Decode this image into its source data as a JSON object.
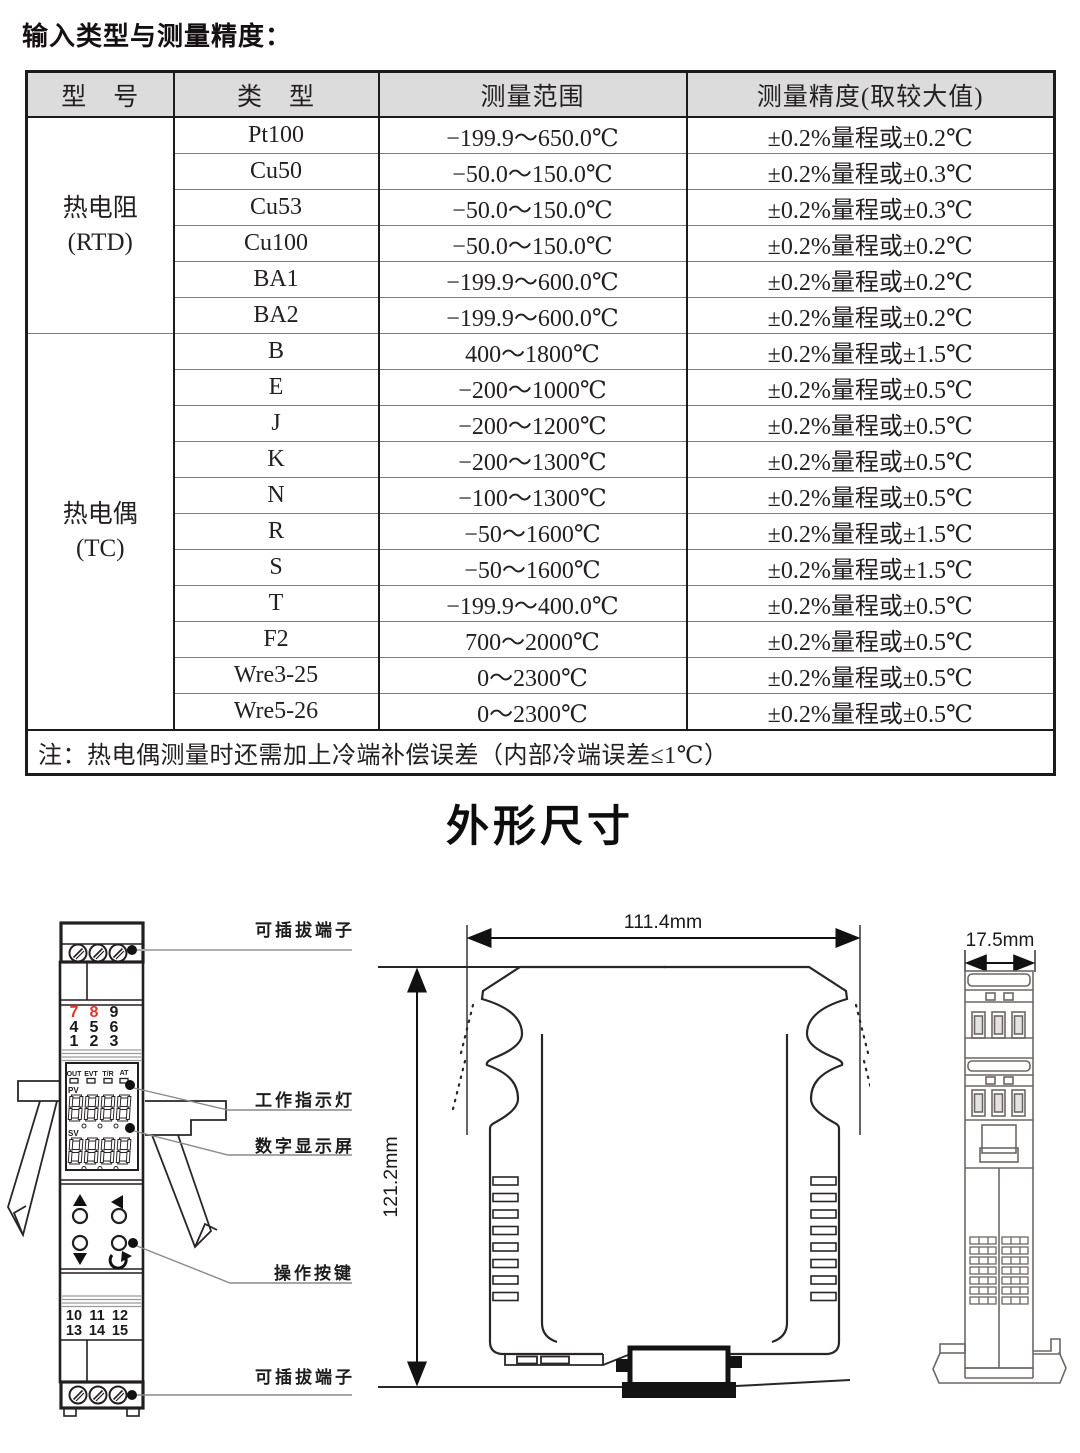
{
  "page": {
    "title": "输入类型与测量精度：",
    "section_title": "外形尺寸"
  },
  "table": {
    "headers": [
      "型　号",
      "类　型",
      "测量范围",
      "测量精度(取较大值)"
    ],
    "group1": {
      "name": "热电阻",
      "abbr": "(RTD)"
    },
    "group2": {
      "name": "热电偶",
      "abbr": "(TC)"
    },
    "rows": [
      {
        "type": "Pt100",
        "range": "−199.9～650.0℃",
        "accuracy": "±0.2%量程或±0.2℃"
      },
      {
        "type": "Cu50",
        "range": "−50.0～150.0℃",
        "accuracy": "±0.2%量程或±0.3℃"
      },
      {
        "type": "Cu53",
        "range": "−50.0～150.0℃",
        "accuracy": "±0.2%量程或±0.3℃"
      },
      {
        "type": "Cu100",
        "range": "−50.0～150.0℃",
        "accuracy": "±0.2%量程或±0.2℃"
      },
      {
        "type": "BA1",
        "range": "−199.9～600.0℃",
        "accuracy": "±0.2%量程或±0.2℃"
      },
      {
        "type": "BA2",
        "range": "−199.9～600.0℃",
        "accuracy": "±0.2%量程或±0.2℃"
      },
      {
        "type": "B",
        "range": "400～1800℃",
        "accuracy": "±0.2%量程或±1.5℃"
      },
      {
        "type": "E",
        "range": "−200～1000℃",
        "accuracy": "±0.2%量程或±0.5℃"
      },
      {
        "type": "J",
        "range": "−200～1200℃",
        "accuracy": "±0.2%量程或±0.5℃"
      },
      {
        "type": "K",
        "range": "−200～1300℃",
        "accuracy": "±0.2%量程或±0.5℃"
      },
      {
        "type": "N",
        "range": "−100～1300℃",
        "accuracy": "±0.2%量程或±0.5℃"
      },
      {
        "type": "R",
        "range": "−50～1600℃",
        "accuracy": "±0.2%量程或±1.5℃"
      },
      {
        "type": "S",
        "range": "−50～1600℃",
        "accuracy": "±0.2%量程或±1.5℃"
      },
      {
        "type": "T",
        "range": "−199.9～400.0℃",
        "accuracy": "±0.2%量程或±0.5℃"
      },
      {
        "type": "F2",
        "range": "700～2000℃",
        "accuracy": "±0.2%量程或±0.5℃"
      },
      {
        "type": "Wre3-25",
        "range": "0～2300℃",
        "accuracy": "±0.2%量程或±0.5℃"
      },
      {
        "type": "Wre5-26",
        "range": "0～2300℃",
        "accuracy": "±0.2%量程或±0.5℃"
      }
    ],
    "note": "注：热电偶测量时还需加上冷端补偿误差（内部冷端误差≤1℃）"
  },
  "drawing": {
    "labels": {
      "terminal_top": "可插拔端子",
      "indicator": "工作指示灯",
      "display": "数字显示屏",
      "buttons": "操作按键",
      "terminal_bottom": "可插拔端子"
    },
    "dimensions": {
      "width": "111.4mm",
      "height": "121.2mm",
      "depth": "17.5mm"
    },
    "module": {
      "numpad_top": [
        [
          "7",
          "8",
          "9"
        ],
        [
          "4",
          "5",
          "6"
        ],
        [
          "1",
          "2",
          "3"
        ]
      ],
      "indicators": [
        "OUT",
        "EVT",
        "T/R",
        "AT"
      ],
      "pv": "PV",
      "sv": "SV",
      "numpad_bottom": [
        [
          "10",
          "11",
          "12"
        ],
        [
          "13",
          "14",
          "15"
        ]
      ]
    },
    "colors": {
      "red": "#e5332a"
    }
  }
}
